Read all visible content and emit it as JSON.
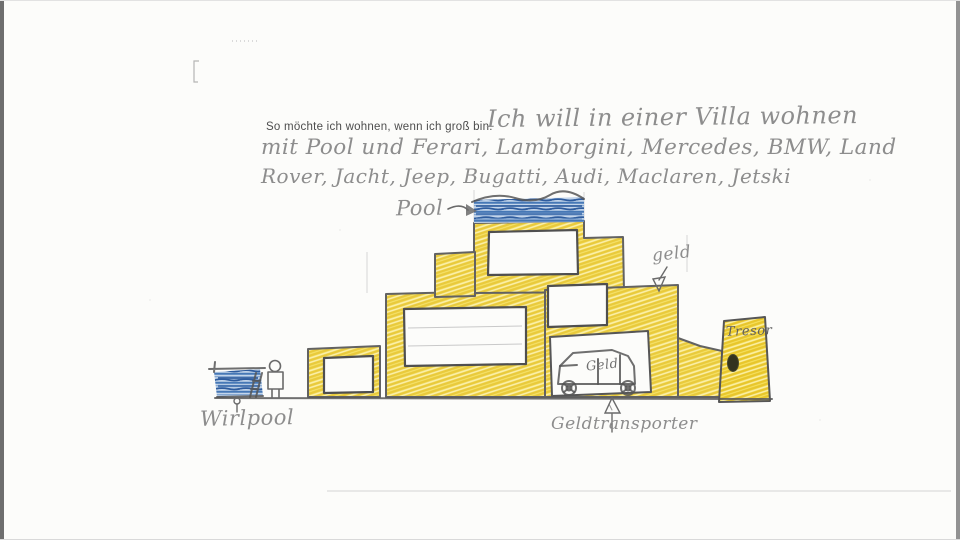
{
  "prompt": {
    "printed": "So möchte ich wohnen, wenn ich groß bin:"
  },
  "handwriting": {
    "line1": "Ich will in einer Villa wohnen",
    "line2": "mit Pool und Ferari, Lamborgini, Mercedes, BMW, Land",
    "line3": "Rover, Jacht, Jeep, Bugatti, Audi, Maclaren, Jetski"
  },
  "labels": {
    "pool": "Pool",
    "geld": "geld",
    "tresor": "Tresor",
    "van": "Geld",
    "geldtransporter": "Geldtransporter",
    "whirlpool": "Wirlpool"
  },
  "colors": {
    "crayon_yellow": "#f7e467",
    "crayon_yellow_dark": "#e8c62b",
    "water_blue_base": "#c3d5ea",
    "water_blue_dark": "#2e5c9e",
    "pencil_gray": "#8d8d8d",
    "outline_gray": "#565656",
    "paper_white": "#fcfcfa"
  }
}
